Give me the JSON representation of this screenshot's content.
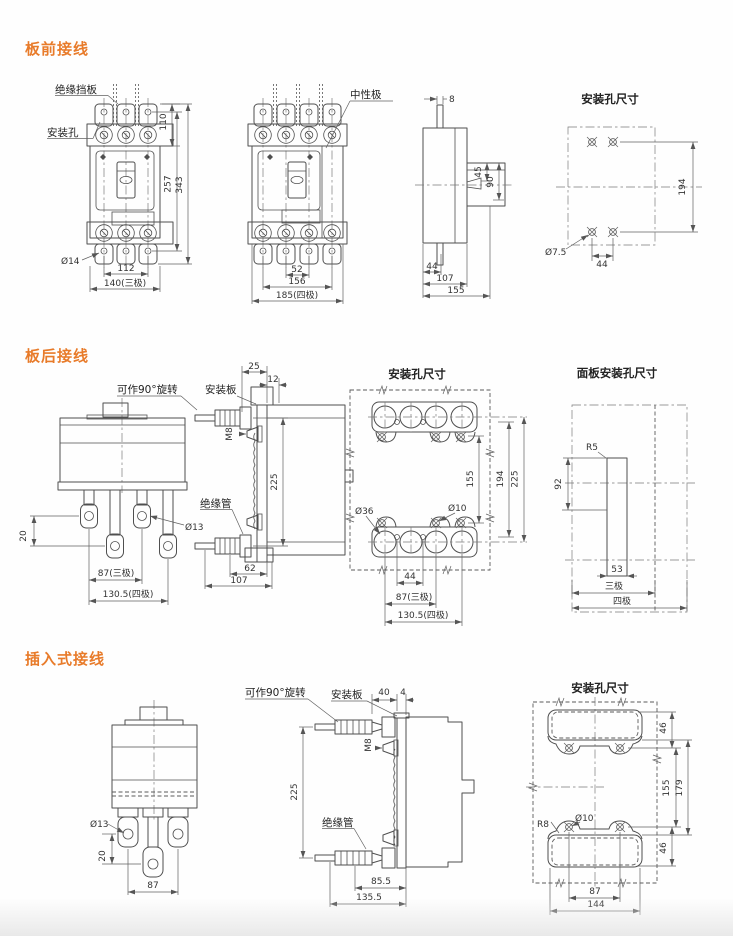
{
  "page": {
    "accent_color": "#e87b2a",
    "line_color": "#4f4f4f"
  },
  "s1": {
    "heading": "板前接线",
    "front3": {
      "baffle": "绝缘挡板",
      "hole": "安装孔",
      "d14": "Ø14",
      "v110": "110",
      "v257": "257",
      "v343": "343",
      "v112": "112",
      "v140": "140(三极)"
    },
    "front4": {
      "neutral": "中性极",
      "v52": "52",
      "v156": "156",
      "v185": "185(四极)"
    },
    "side": {
      "v8": "8",
      "v45": "45",
      "v90": "90",
      "v44": "44",
      "v107": "107",
      "v155": "155"
    },
    "holes": {
      "title": "安装孔尺寸",
      "d75": "Ø7.5",
      "v44": "44",
      "v194": "194"
    }
  },
  "s2": {
    "heading": "板后接线",
    "rear": {
      "rotate": "可作90°旋转",
      "d13": "Ø13",
      "v20": "20",
      "v87": "87(三极)",
      "v1305": "130.5(四极)"
    },
    "side": {
      "plate": "安装板",
      "tube": "绝缘管",
      "m8": "M8",
      "v25": "25",
      "v12": "12",
      "v225": "225",
      "v62": "62",
      "v107": "107"
    },
    "holes": {
      "title": "安装孔尺寸",
      "d36": "Ø36",
      "d10": "Ø10",
      "v155": "155",
      "v194": "194",
      "v225": "225",
      "v44": "44",
      "v87": "87(三极)",
      "v1305": "130.5(四极)"
    },
    "panel": {
      "title": "面板安装孔尺寸",
      "r5": "R5",
      "v92": "92",
      "v53": "53",
      "p3": "三极",
      "p4": "四极"
    }
  },
  "s3": {
    "heading": "插入式接线",
    "front": {
      "d13": "Ø13",
      "v20": "20",
      "v87": "87"
    },
    "side": {
      "rotate": "可作90°旋转",
      "plate": "安装板",
      "tube": "绝缘管",
      "m8": "M8",
      "v40": "40",
      "v4": "4",
      "v225": "225",
      "v855": "85.5",
      "v1355": "135.5"
    },
    "holes": {
      "title": "安装孔尺寸",
      "r8": "R8",
      "d10": "Ø10",
      "v46a": "46",
      "v155": "155",
      "v179": "179",
      "v46b": "46",
      "v87": "87",
      "v144": "144"
    }
  }
}
